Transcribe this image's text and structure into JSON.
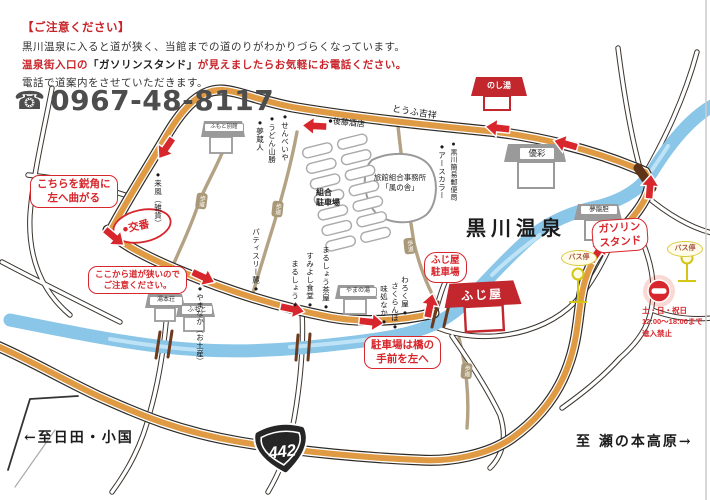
{
  "notice": {
    "title": "【ご注意ください】",
    "line1": "黒川温泉に入ると道が狭く、当館までの道のりがわかりづらくなっています。",
    "line2_pre": "温泉街入口の",
    "line2_quote": "「ガソリンスタンド」",
    "line2_post": "が見えましたらお気軽にお電話ください。",
    "line3": "電話で道案内をさせていただきます。",
    "phone_icon": "☎",
    "phone_number": "0967-48-8117"
  },
  "map": {
    "area_title": "黒川温泉",
    "destination": "ふじ屋",
    "noshiyu": "のし湯",
    "callouts": {
      "turn_left_1": "こちらを鋭角に",
      "turn_left_2": "左へ曲がる",
      "narrow_1": "ここから道が狭いので",
      "narrow_2": "ご注意ください。",
      "bridge_1": "駐車場は橋の",
      "bridge_2": "手前を左へ",
      "fujiya_parking_1": "ふじ屋",
      "fujiya_parking_2": "駐車場",
      "gas_1": "ガソリン",
      "gas_2": "スタンド"
    },
    "koban": "●交番",
    "bus_stop": "バス停",
    "no_entry": {
      "line1": "土・日・祝日",
      "line2": "12:00～18:00まで",
      "line3": "進入禁止"
    },
    "buildings": {
      "yusai": "優彩",
      "yumerindo": "夢龍胆",
      "yumotoso": "湯本荘",
      "fumoto": "ふもと",
      "yamanoyu": "やまの湯",
      "fumoto_bekkan": "ふもと別館"
    },
    "office_1": "旅館組合事務所",
    "office_2": "「風の舎」",
    "parking_1": "組合",
    "parking_2": "駐車場",
    "shops": {
      "senbeiya": "●せんべいや",
      "udon": "●うどん山勝",
      "yumekurando": "●夢蔵人",
      "earthcolor": "●アースカラー",
      "post_office": "●黒川簡易郵便局",
      "raifu": "●来風（雑貨）",
      "yamanaka": "●やまなか（お土産）",
      "patisserie": "パティスリー麓●",
      "marusho_chaya": "まるしょう茶屋●",
      "sumiyoshi": "すみよし食堂●",
      "marusho": "まるしょう●",
      "warokuya": "わろく屋●",
      "sakuranbo": "さくらんぼ●",
      "ajidokoro": "味処なか●",
      "goto_saketen": "●後藤酒店",
      "tofu_kissho": "とうふ吉祥"
    },
    "sidewalk": "歩道",
    "route_shield": "442",
    "dir_left": "←至日田・小国",
    "dir_right": "至 瀬の本高原→",
    "colors": {
      "route_orange": "#df9a43",
      "accent_red": "#d7262c",
      "river_blue": "#8ac6e8"
    }
  }
}
